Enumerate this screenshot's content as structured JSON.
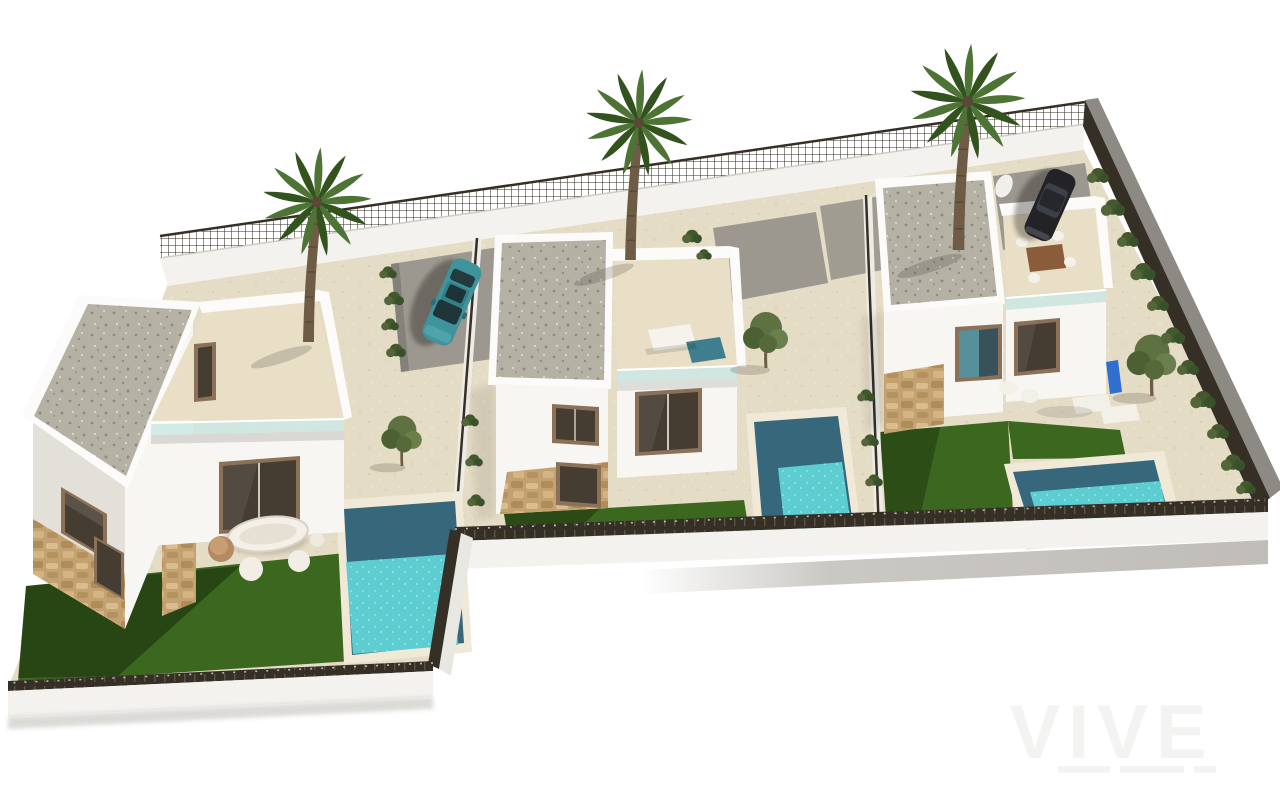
{
  "watermark": {
    "text": "VIVE"
  },
  "colors": {
    "background": "#ffffff",
    "ground": "#e5dcc6",
    "ground_speck": "#d6cbaf",
    "tile": "#e9dfc6",
    "concrete": "#9c988f",
    "concrete_dark": "#84817a",
    "lawn": "#3c671f",
    "pool_water": "#5ecdd1",
    "pool_bright": "#8ae6e4",
    "pool_wall": "#36677a",
    "coping": "#f0e9d8",
    "wall_white": "#f7f6f2",
    "wall_shade": "#e3e0d9",
    "wall_dark": "#d5d2ca",
    "parapet": "#fcfbf9",
    "roof_gravel": "#b6b1a5",
    "roof_gravel_dot": "#908b7f",
    "stone": "#c4a171",
    "stone_dark": "#a8844f",
    "glass": "#453c32",
    "glass_frame": "#8a7158",
    "balustrade": "#cde9e5",
    "fence": "#362f26",
    "fence_mesh": "#6b6357",
    "plinth": "#f3f2ee",
    "street": "#b9b6b0",
    "palm_leaf": "#4d7335",
    "palm_leaf_dark": "#33531e",
    "trunk": "#6f5c46",
    "car_teal": "#3f939b",
    "car_glass": "#20353a",
    "suv": "#232327",
    "shrub": "#44582e",
    "tree_leaf": "#5d7240",
    "watermark_gray": "#f3f3f2"
  }
}
